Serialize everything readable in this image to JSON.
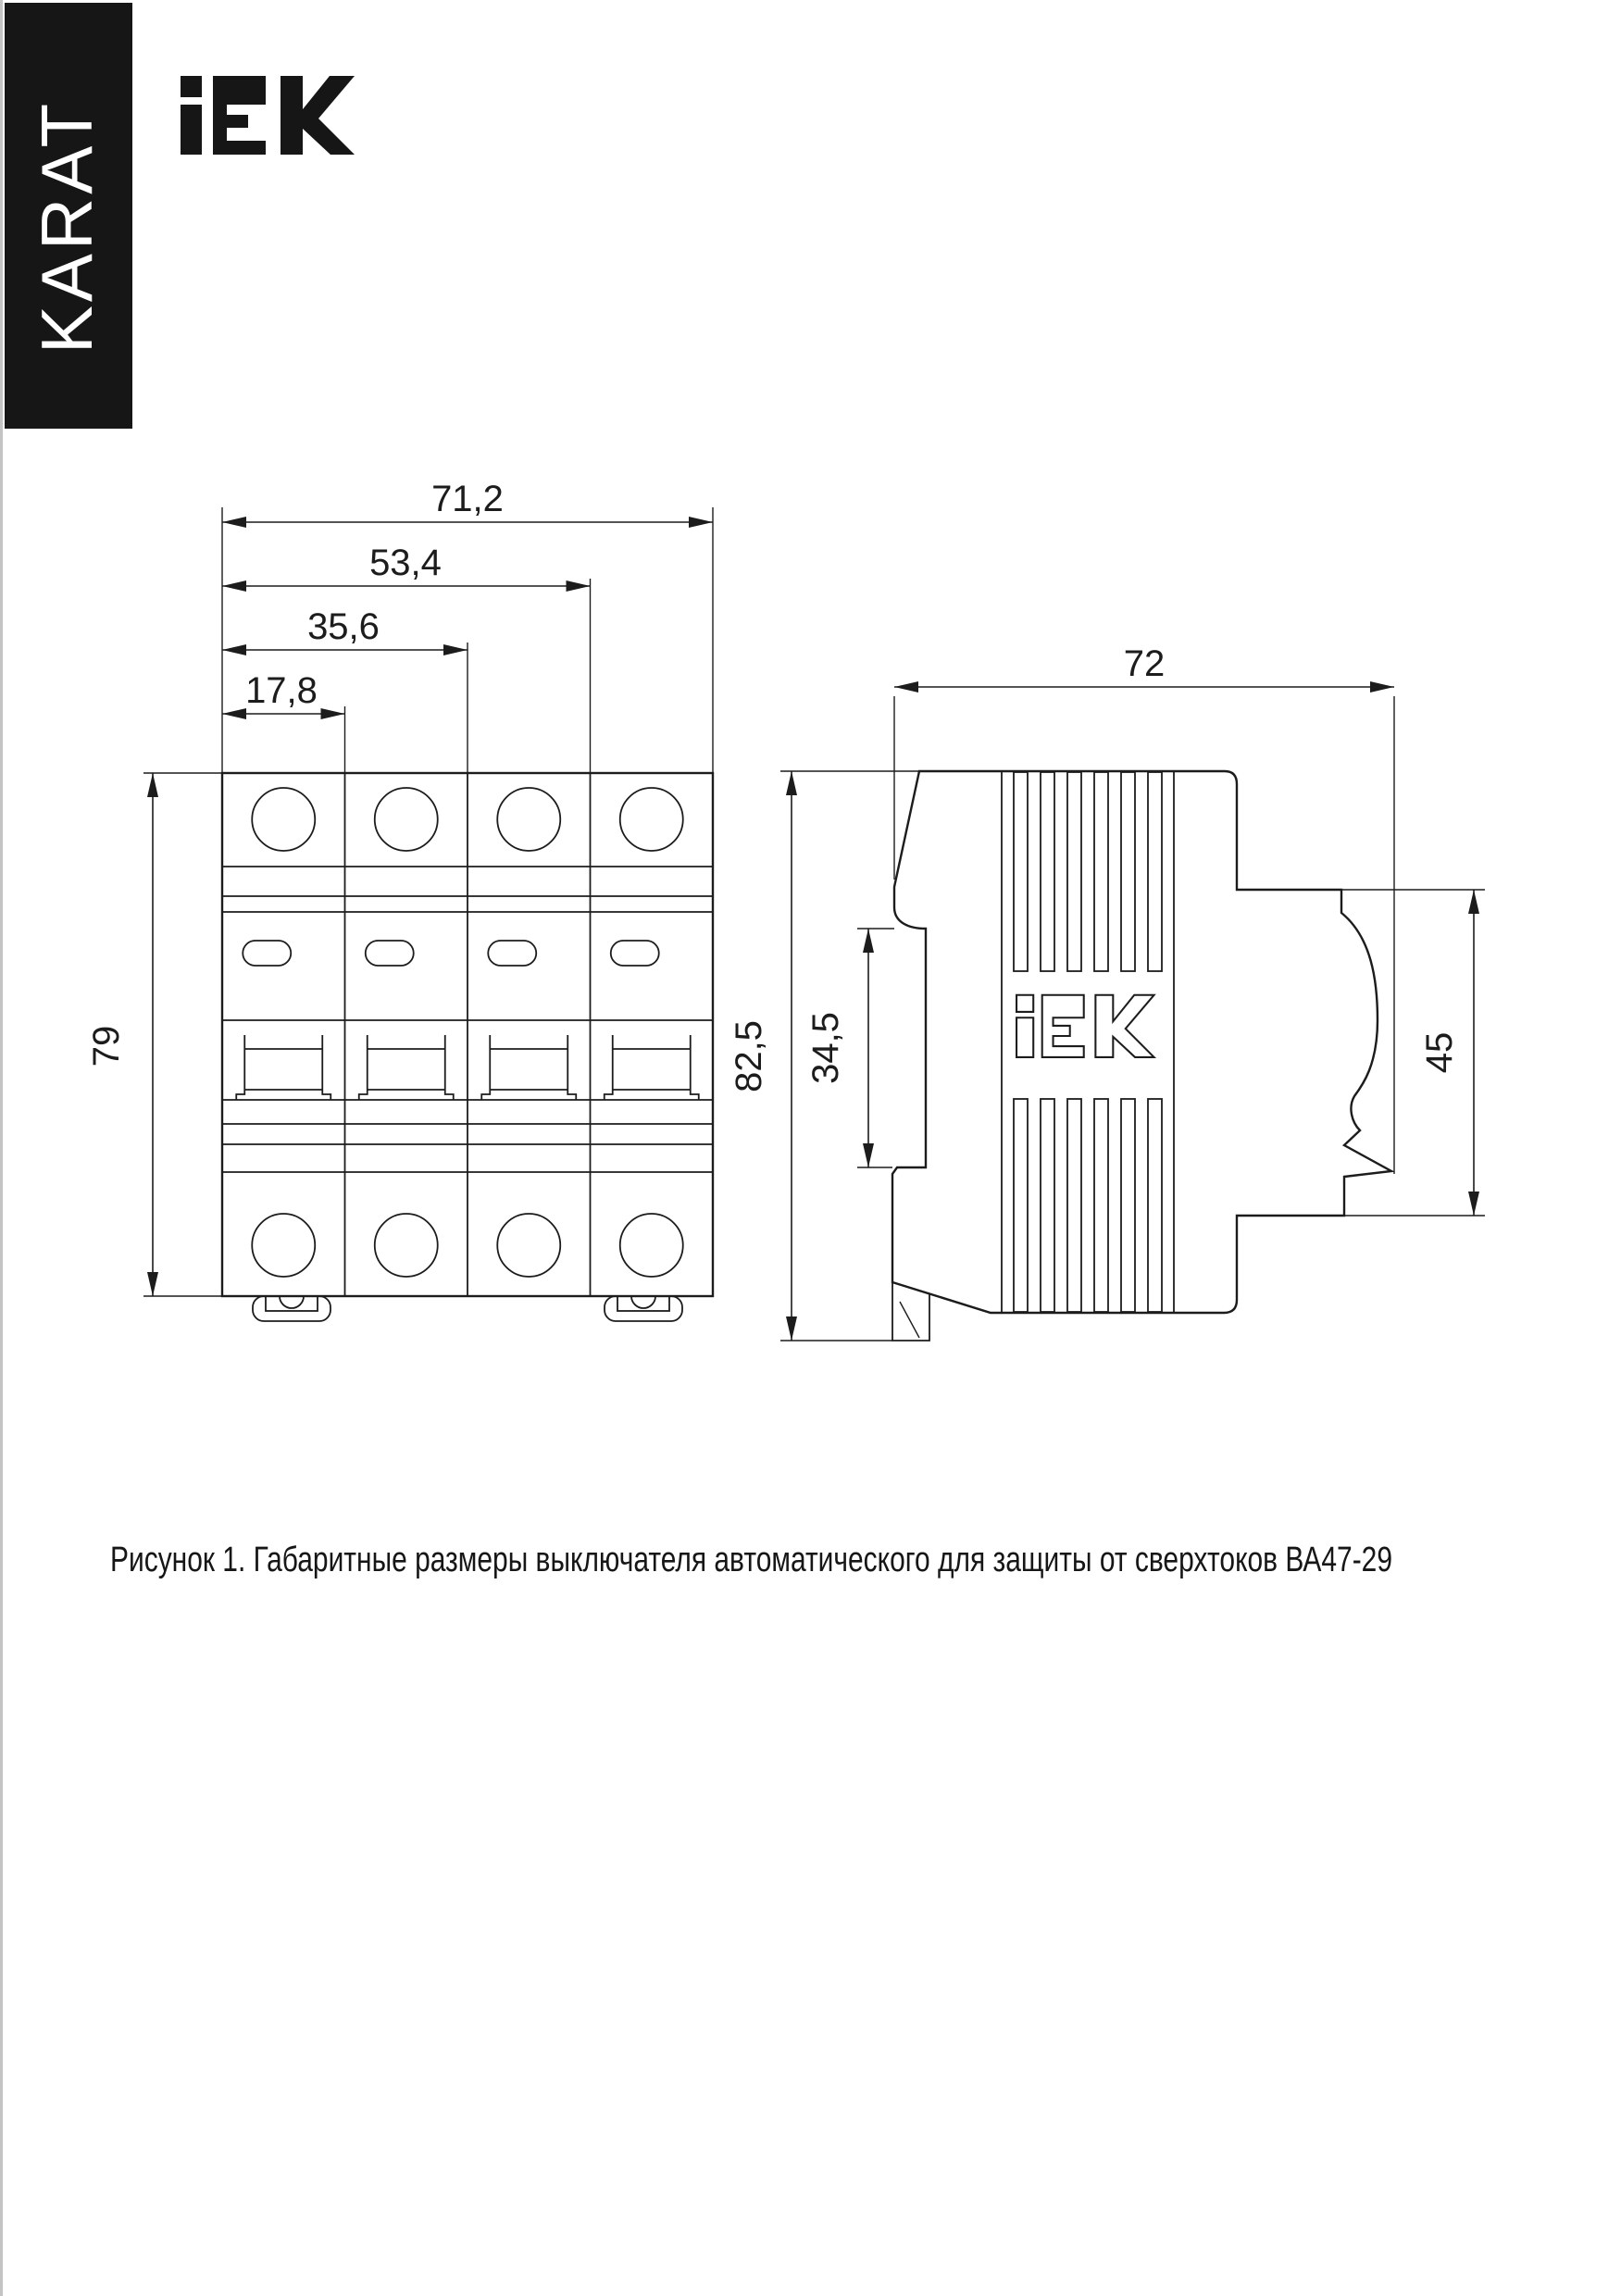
{
  "branding": {
    "sidebar_text": "KARAT",
    "logo_text": "IEK"
  },
  "figure": {
    "caption": "Рисунок 1. Габаритные размеры выключателя автоматического для защиты от сверхтоков ВА47-29"
  },
  "front_view": {
    "dim_width_total": "71,2",
    "dim_width_three_pole": "53,4",
    "dim_width_two_pole": "35,6",
    "dim_width_one_pole": "17,8",
    "dim_height": "79"
  },
  "side_view": {
    "dim_depth": "72",
    "dim_height_total": "82,5",
    "dim_rail_channel": "34,5",
    "dim_front_module": "45"
  },
  "colors": {
    "ink": "#1c1c1c",
    "paper": "#ffffff",
    "banner": "#161616"
  }
}
